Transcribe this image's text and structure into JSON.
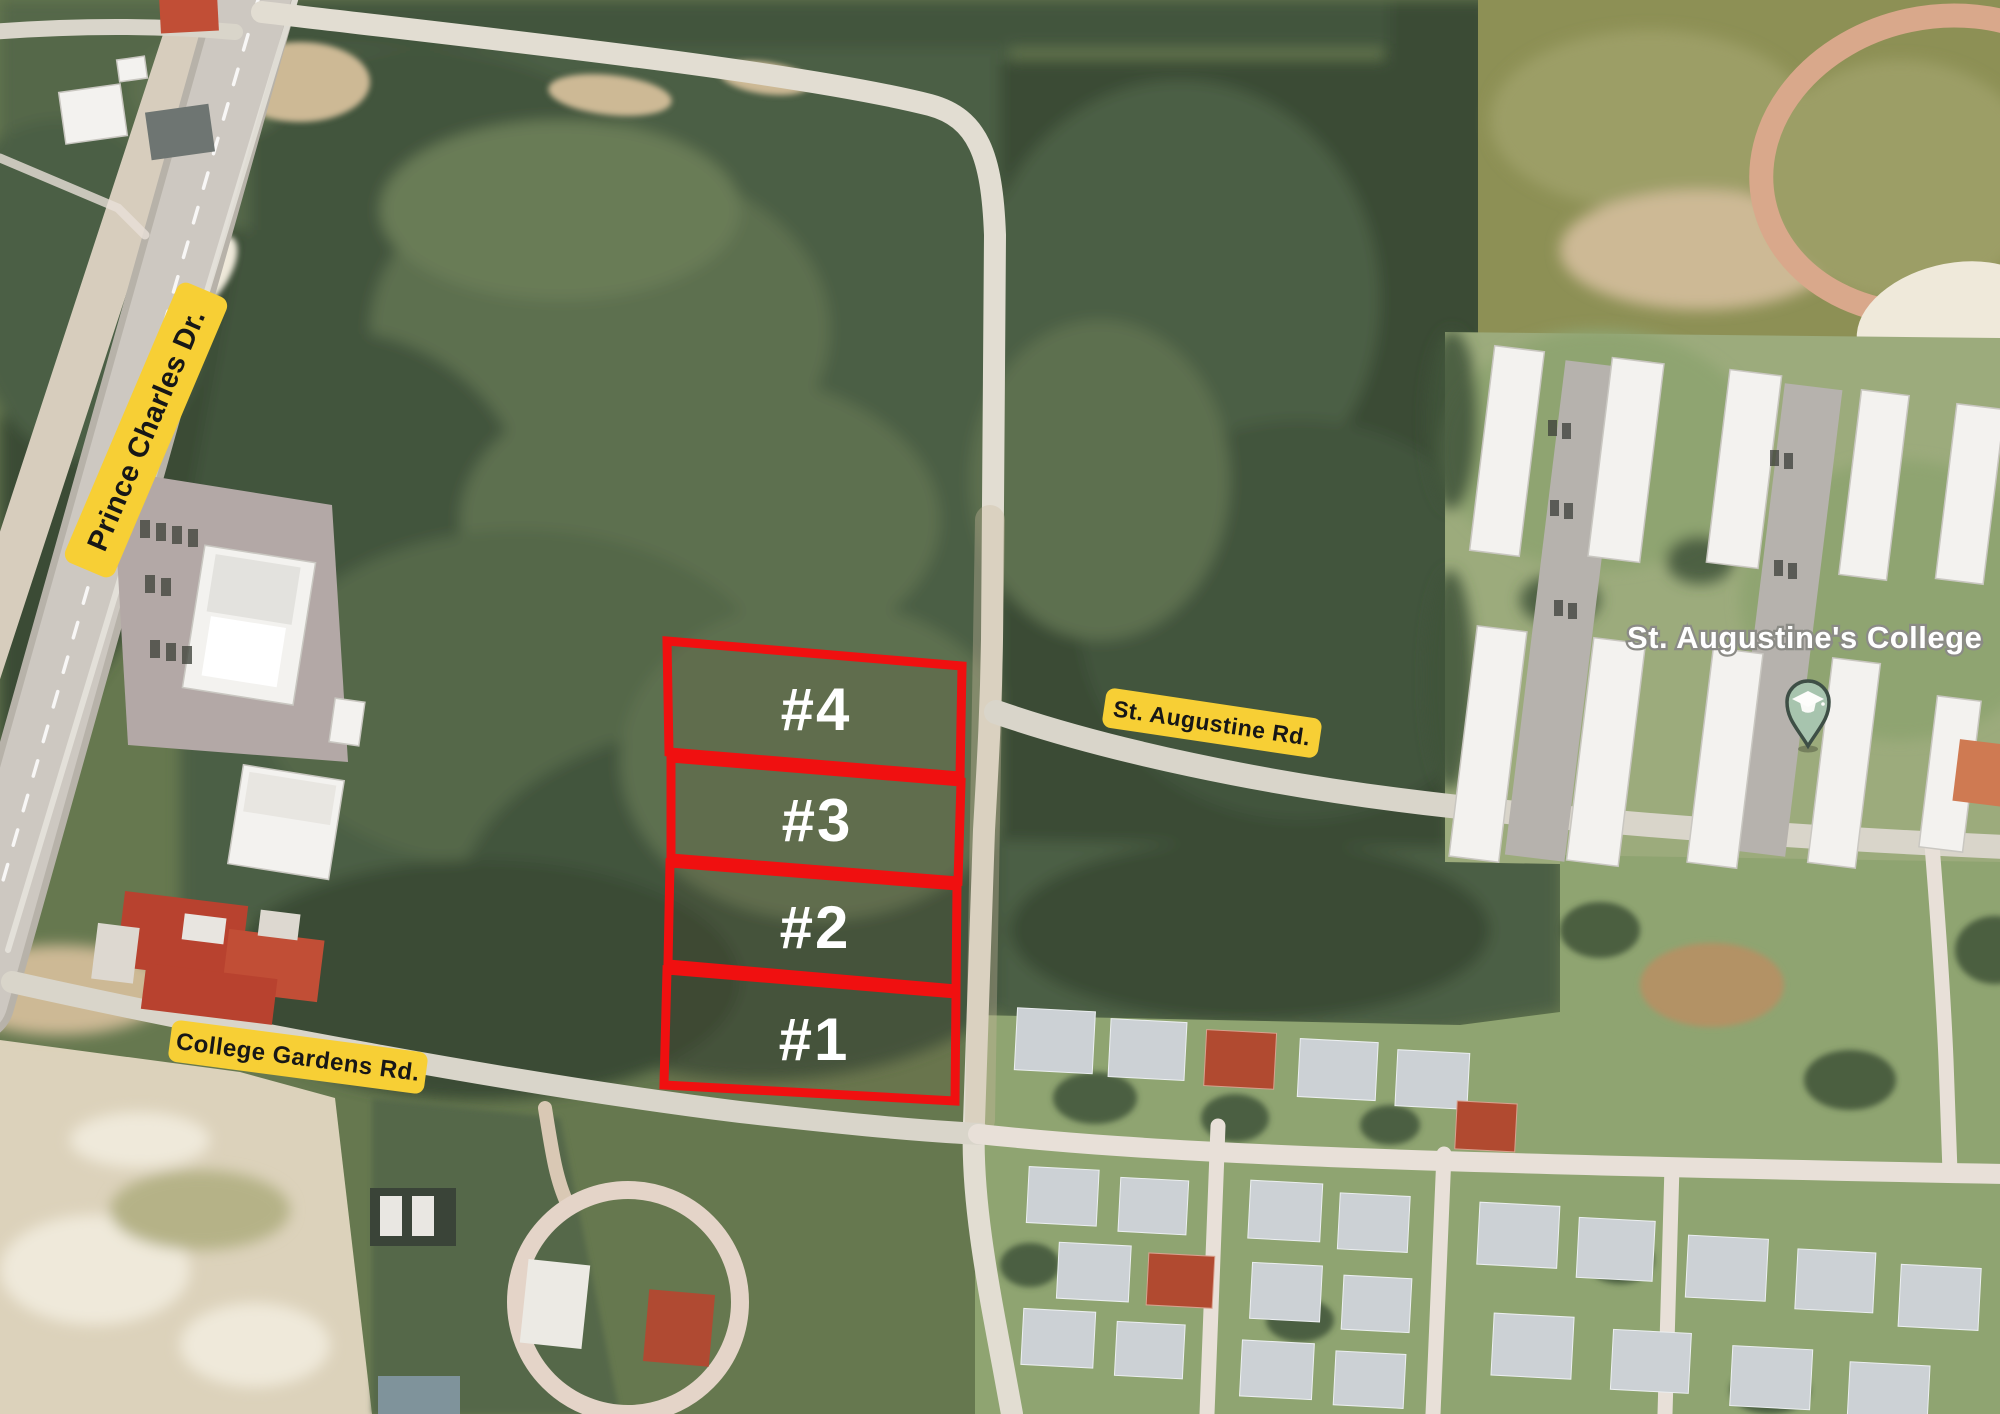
{
  "map": {
    "place_label": "St. Augustine's College",
    "road_labels": {
      "prince_charles": "Prince Charles Dr.",
      "st_augustine": "St. Augustine Rd.",
      "college_gardens": "College Gardens Rd."
    },
    "lots": [
      {
        "label": "#1"
      },
      {
        "label": "#2"
      },
      {
        "label": "#3"
      },
      {
        "label": "#4"
      }
    ],
    "pin": {
      "icon": "graduation-cap-pin"
    },
    "colors": {
      "lot_outline": "#f01010",
      "road_label_bg": "#f7cf35",
      "road_label_text": "#171717",
      "place_label_fill": "#ffffff",
      "place_label_outline": "#8b8b86",
      "pin_fill": "#a7c4ae",
      "pin_outline": "#3e4f46"
    }
  }
}
